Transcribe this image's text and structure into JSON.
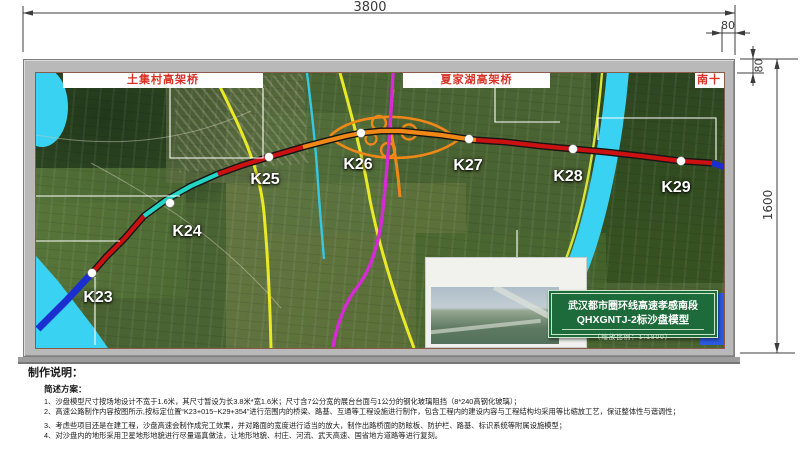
{
  "dimensions": {
    "top_width": "3800",
    "right_border_width": "80",
    "top_border_height": "80",
    "right_height": "1600"
  },
  "map": {
    "bridge_labels": [
      {
        "text": "土集村高架桥"
      },
      {
        "text": "夏家湖高架桥"
      },
      {
        "text": "南十"
      }
    ],
    "stations": [
      {
        "label": "K23"
      },
      {
        "label": "K24"
      },
      {
        "label": "K25"
      },
      {
        "label": "K26"
      },
      {
        "label": "K27"
      },
      {
        "label": "K28"
      },
      {
        "label": "K29"
      }
    ],
    "edge_sign_text": "国"
  },
  "title_box": {
    "line1": "武汉都市圈环线高速孝感南段",
    "line2": "QHXGNTJ-2标沙盘模型",
    "scale_note": "（缩放比例：1:1800）"
  },
  "notes": {
    "heading": "制作说明：",
    "subheading": "简述方案：",
    "items": [
      "1、沙盘模型尺寸按场地设计不宽于1.6米，其尺寸暂设为长3.8米*宽1.6米；尺寸含7公分宽的展台台面与1公分的钢化玻璃阻挡（8*240高钢化玻璃）；",
      "2、高速公路制作内容按图所示,按标定位置“K23+015~K29+354”进行范围内的桥梁、路基、互通等工程设施进行制作，包含工程内的建设内容与工程结构均采用等比缩放工艺，保证整体性与谐调性；",
      "3、考虑些项目还是在建工程，沙盘高速会制作成完工效果，并对路面的宽度进行适当的放大，制作出路桥面的防眩板、防护栏、路基、标识系统等附属设施模型；",
      "4、对沙盘内的地形采用卫星地形地貌进行尽量逼真做法，让地形地貌、村庄、河流、武天高速、国省地方道路等进行复刻。"
    ]
  },
  "colors": {
    "route_red": "#cc1111",
    "route_orange": "#f08818",
    "route_cyan": "#22d6c6",
    "route_blue": "#1b2fd0",
    "existing_yellow": "#e9e926",
    "existing_magenta": "#d42bd4",
    "water_cyan": "#3ad2f2",
    "title_green": "#1d6b3a",
    "label_red": "#d93025"
  }
}
